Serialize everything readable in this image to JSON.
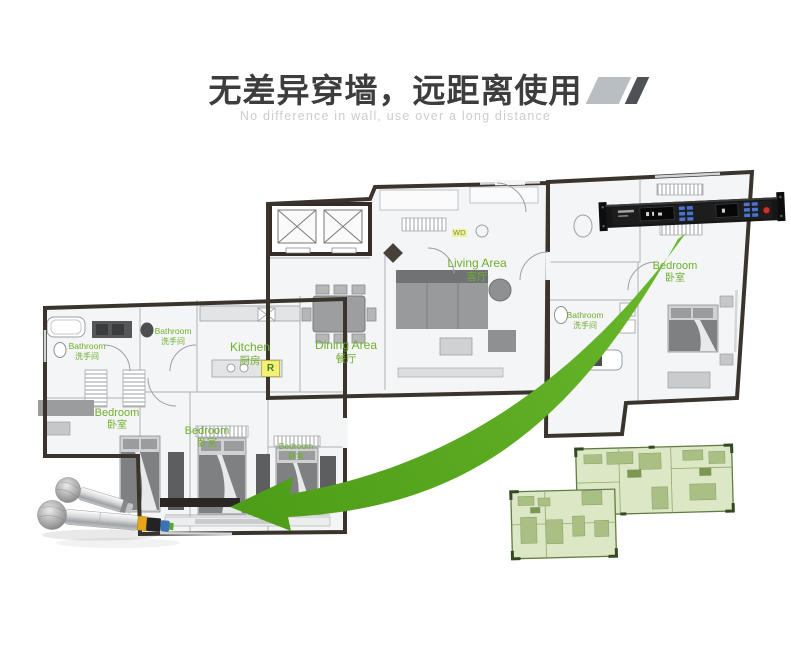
{
  "header": {
    "title": "无差异穿墙，远距离使用",
    "subtitle": "No difference in wall, use over a long distance"
  },
  "floorplan": {
    "rooms": [
      {
        "key": "living-area",
        "en": "Living Area",
        "zh": "客厅"
      },
      {
        "key": "dining-area",
        "en": "Dining Area",
        "zh": "餐厅"
      },
      {
        "key": "kitchen",
        "en": "Kitchen",
        "zh": "厨房"
      },
      {
        "key": "bathroom-left",
        "en": "Bathroom",
        "zh": "洗手间"
      },
      {
        "key": "bathroom-middle",
        "en": "Bathroom",
        "zh": "洗手间"
      },
      {
        "key": "bathroom-right",
        "en": "Bathroom",
        "zh": "洗手间"
      },
      {
        "key": "bedroom-left",
        "en": "Bedroom",
        "zh": "卧室"
      },
      {
        "key": "bedroom-middle",
        "en": "Bedroom",
        "zh": "卧室"
      },
      {
        "key": "bedroom-small",
        "en": "Bedroom",
        "zh": "卧室"
      },
      {
        "key": "bedroom-right",
        "en": "Bedroom",
        "zh": "卧室"
      }
    ],
    "appliance_tags": {
      "washer_dryer": "WD",
      "refrigerator": "R"
    }
  },
  "graphics": {
    "device_icon": "wireless-receiver",
    "microphones_icon": "handheld-wireless-microphones",
    "arrow_icon": "signal-path-arrow",
    "thumbnail_icon": "mini-floorplan"
  },
  "colors": {
    "label_green": "#6fae2e",
    "arrow_green": "#55a41e",
    "title_gray": "#3d3d3d",
    "subtitle_gray": "#cbcdce",
    "slash_light": "#b9bec2",
    "slash_dark": "#4e5256"
  }
}
